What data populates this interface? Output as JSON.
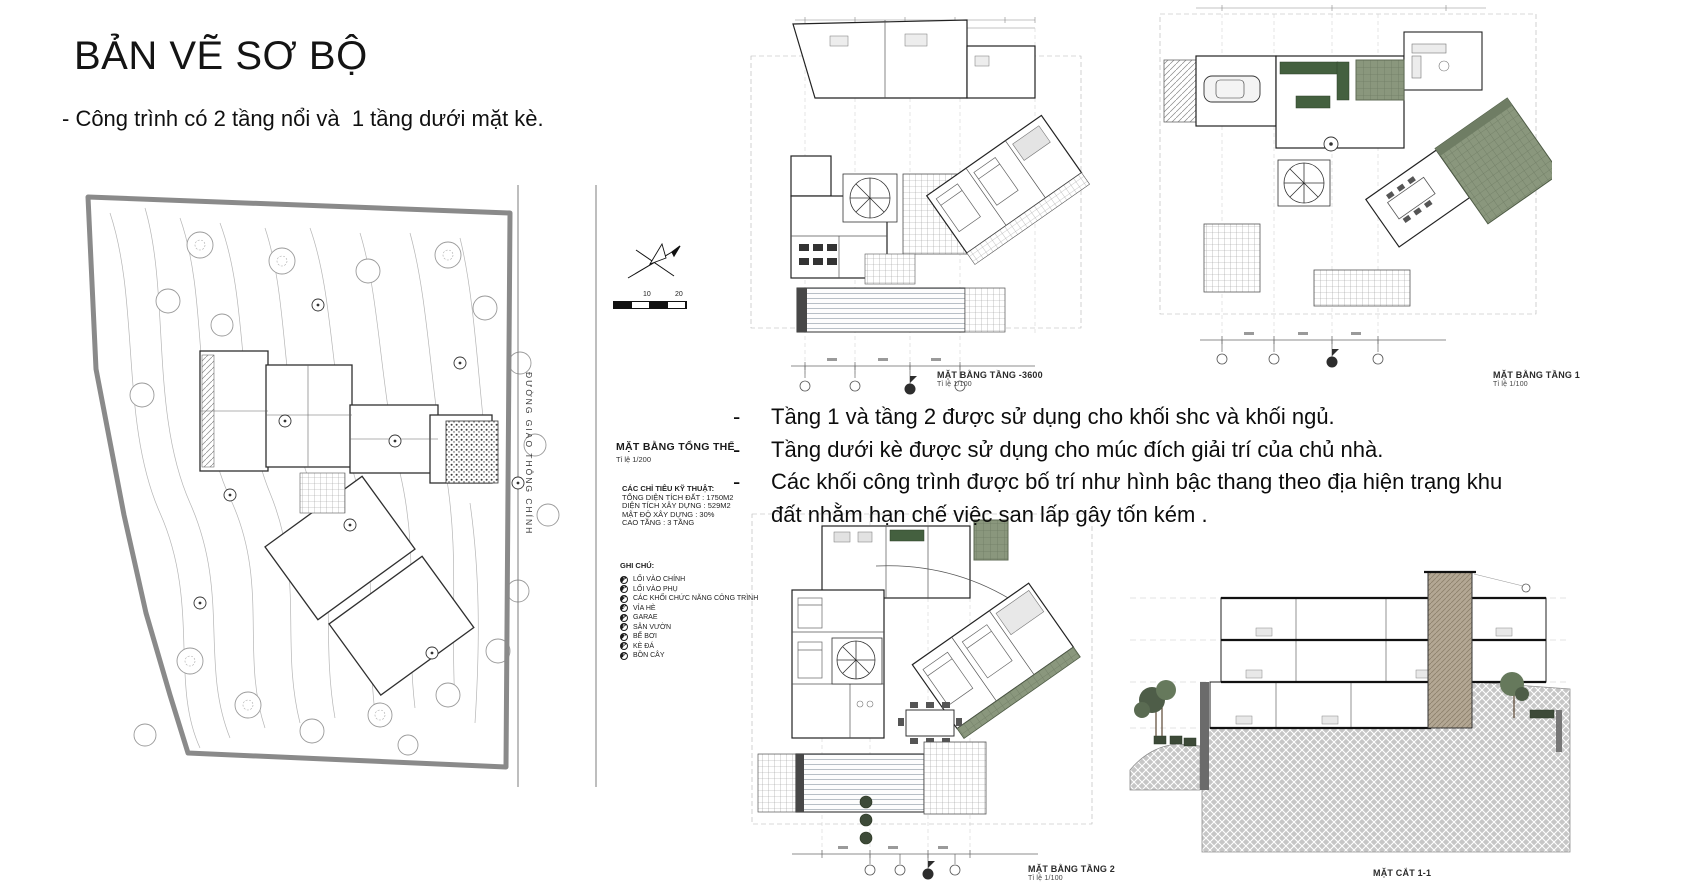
{
  "page": {
    "title": "BẢN VẼ SƠ BỘ",
    "subtitle": "- Công trình có 2 tầng nổi và  1 tầng dưới mặt kè."
  },
  "site": {
    "title": "MẶT BẰNG TỔNG THỂ",
    "scale": "Tỉ lệ 1/200",
    "road_label": "ĐƯỜNG GIAO THÔNG CHÍNH",
    "scalebar": [
      "10",
      "20"
    ],
    "specs": {
      "heading": "CÁC CHỈ TIÊU KỸ THUẬT:",
      "items": [
        "TỔNG DIỆN TÍCH ĐẤT : 1750M2",
        "DIỆN TÍCH XÂY DỰNG : 529M2",
        "MẬT ĐỘ XÂY DỰNG : 30%",
        "CAO TẦNG : 3 TẦNG"
      ]
    },
    "legend": {
      "heading": "GHI CHÚ:",
      "items": [
        {
          "num": "1",
          "label": "LỐI VÀO CHÍNH"
        },
        {
          "num": "2",
          "label": "LỐI VÀO PHỤ"
        },
        {
          "num": "3",
          "label": "CÁC KHỐI CHỨC NĂNG CÔNG TRÌNH"
        },
        {
          "num": "4",
          "label": "VỈA HÈ"
        },
        {
          "num": "5",
          "label": "GARAE"
        },
        {
          "num": "6",
          "label": "SÂN VƯỜN"
        },
        {
          "num": "7",
          "label": "BỂ BƠI"
        },
        {
          "num": "8",
          "label": "KÈ ĐÁ"
        },
        {
          "num": "9",
          "label": "BỒN CÂY"
        }
      ]
    }
  },
  "notes": {
    "bullet": "-",
    "items": [
      "Tầng 1 và tầng 2 được sử dụng cho khối shc và khối ngủ.",
      "Tầng dưới kè được sử dụng cho múc đích giải trí của chủ nhà.",
      "Các khối công trình được bố trí như hình bậc thang theo địa hiện trạng khu đất nhằm hạn chế việc san lấp gây tốn kém ."
    ]
  },
  "drawings": {
    "basement": {
      "title": "MẶT BẰNG TẦNG -3600",
      "scale": "Tỉ lệ 1/100"
    },
    "floor1": {
      "title": "MẶT BẰNG TẦNG 1",
      "scale": "Tỉ lệ 1/100"
    },
    "floor2": {
      "title": "MẶT BẰNG TẦNG 2",
      "scale": "Tỉ lệ 1/100"
    },
    "section": {
      "title": "MẶT CẮT 1-1"
    }
  },
  "colors": {
    "accent_green": "#44603f",
    "sage_terrace": "#8a977d",
    "ground_hatch": "#c6c6c6",
    "site_boundary": "#8a8a8a",
    "linework": "#2f2f2f"
  }
}
